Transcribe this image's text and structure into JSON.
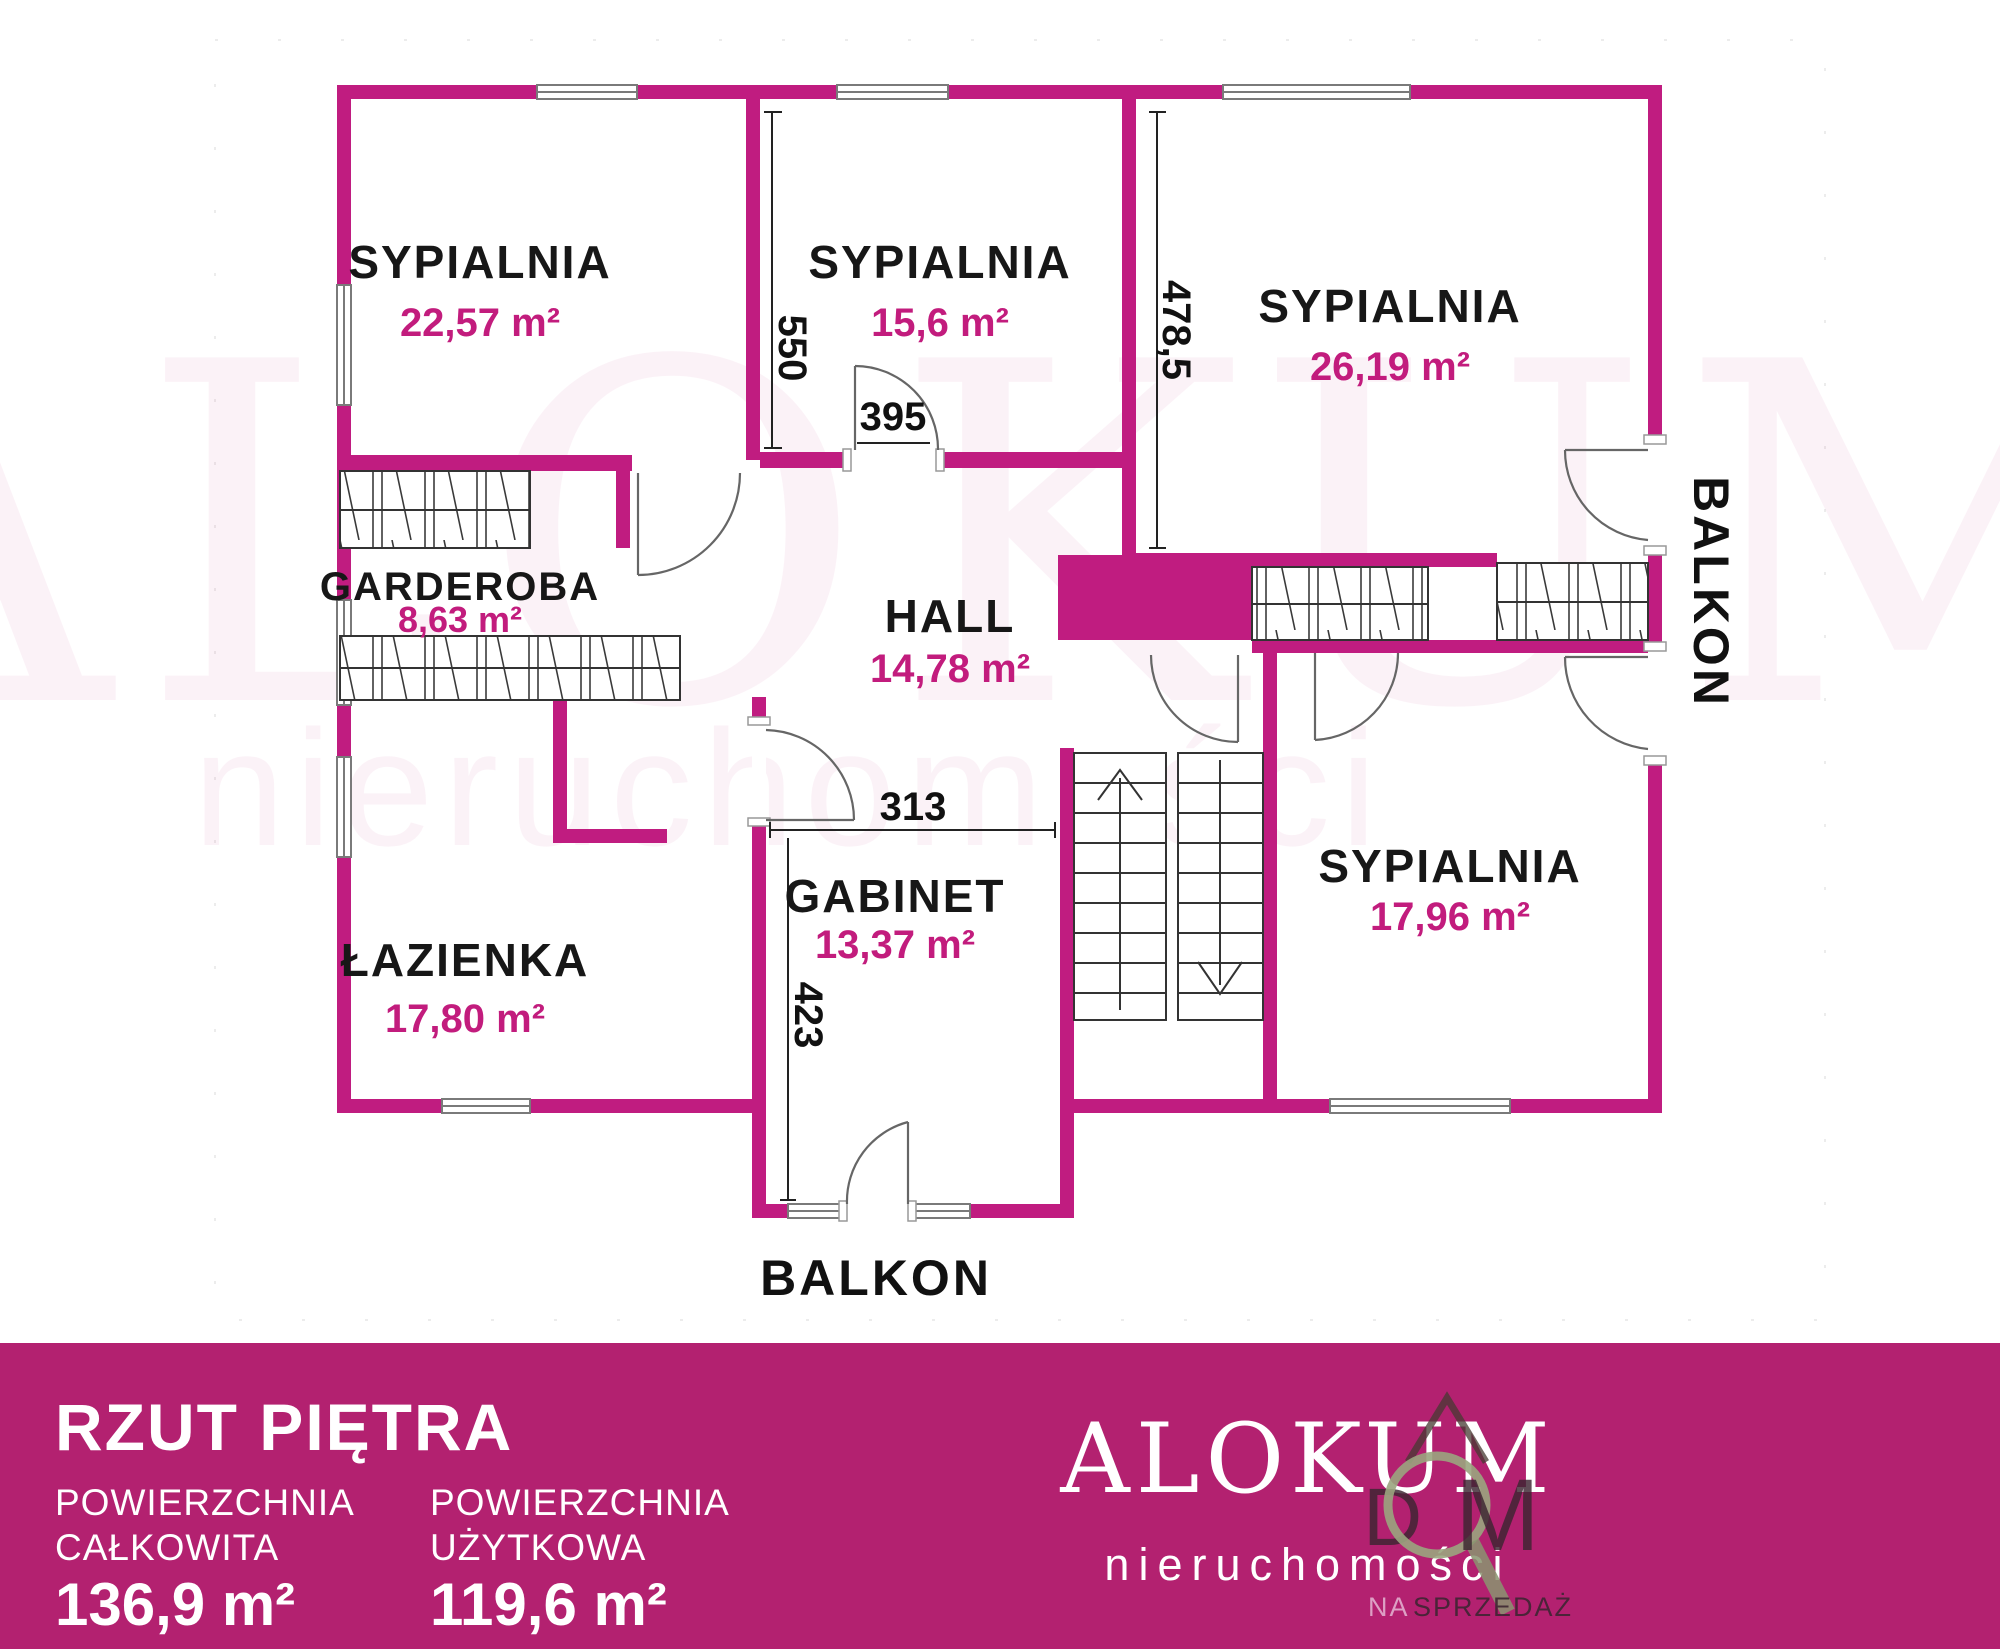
{
  "colors": {
    "wall": "#c01c80",
    "footer_bg": "#b32170",
    "area_text": "#c21c7d",
    "room_text": "#171717"
  },
  "plan": {
    "watermark": {
      "line1": "ALOKUM",
      "line2": "nieruchomości"
    },
    "rooms": [
      {
        "name": "SYPIALNIA",
        "area": "22,57 m²"
      },
      {
        "name": "SYPIALNIA",
        "area": "15,6 m²"
      },
      {
        "name": "SYPIALNIA",
        "area": "26,19 m²"
      },
      {
        "name": "GARDEROBA",
        "area": "8,63 m²"
      },
      {
        "name": "HALL",
        "area": "14,78 m²"
      },
      {
        "name": "ŁAZIENKA",
        "area": "17,80 m²"
      },
      {
        "name": "GABINET",
        "area": "13,37 m²"
      },
      {
        "name": "SYPIALNIA",
        "area": "17,96 m²"
      }
    ],
    "dimensions": {
      "bedroom1_side": "550",
      "bedroom2_door": "395",
      "bedroom3_side": "478,5",
      "gabinet_top": "313",
      "gabinet_side": "423"
    },
    "balconies": {
      "bottom": "BALKON",
      "right": "BALKON"
    }
  },
  "footer": {
    "title": "RZUT PIĘTRA",
    "metrics": [
      {
        "label_line1": "POWIERZCHNIA",
        "label_line2": "CAŁKOWITA",
        "value": "136,9 m²"
      },
      {
        "label_line1": "POWIERZCHNIA",
        "label_line2": "UŻYTKOWA",
        "value": "119,6 m²"
      }
    ],
    "brand": {
      "name": "ALOKUM",
      "subtitle": "nieruchomości",
      "overlay_word_d": "D",
      "overlay_word_m": "M",
      "overlay_small_1": "NA",
      "overlay_small_2": "SPRZEDAŻ"
    }
  }
}
